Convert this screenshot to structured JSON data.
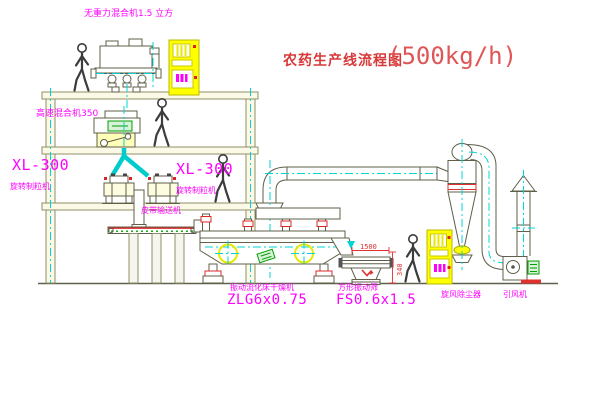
{
  "title": {
    "cn": "农药生产线流程图",
    "capacity": "(500kg/h)"
  },
  "labels": {
    "top_mixer": "无重力混合机1.5 立方",
    "high_speed_mixer": "高速混合机350",
    "granulator_left_model": "XL-300",
    "granulator_left_name": "旋转制粒机",
    "granulator_right_model": "XL-300",
    "granulator_right_name": "旋转制粒机",
    "belt_conveyor": "皮带输送机",
    "dryer_name": "振动流化床干燥机",
    "dryer_model": "ZLG6x0.75",
    "screen_name": "方形振动筛",
    "screen_model": "FS0.6x1.5",
    "cyclone_name": "旋风除尘器",
    "fan_name": "引风机"
  },
  "dimensions": {
    "screen_length": "1500",
    "screen_height": "340"
  },
  "colors": {
    "label_magenta": "#ff00ff",
    "title_red": "#d83838",
    "centerline_cyan": "#00d4d4",
    "cabinet_yellow": "#ffff00",
    "motor_green": "#00a000",
    "dimension_red": "#e03030",
    "structure_line": "#5f5f4a"
  }
}
